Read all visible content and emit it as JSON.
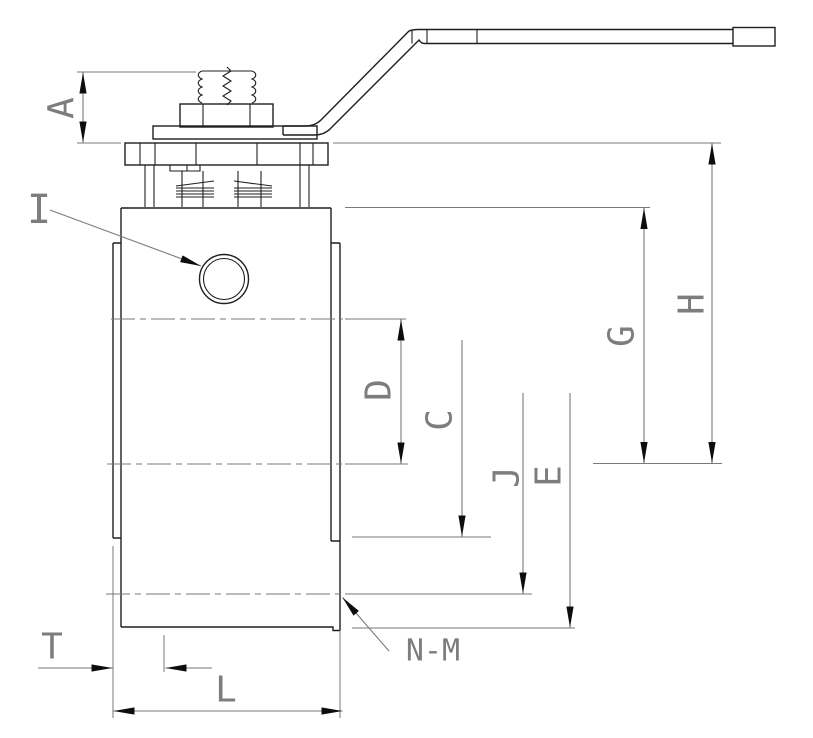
{
  "drawing": {
    "kind": "ball-valve-dimension-drawing",
    "labels": {
      "A": "A",
      "I": "I",
      "D": "D",
      "C": "C",
      "J": "J",
      "E": "E",
      "G": "G",
      "H": "H",
      "T": "T",
      "L": "L",
      "NM": "N-M"
    },
    "colors": {
      "paper": "#ffffff",
      "ink": "#1f1f1f",
      "dim": "#7a7a7a",
      "label": "#7d7d7d",
      "arrow": "#0d0d0d"
    }
  }
}
